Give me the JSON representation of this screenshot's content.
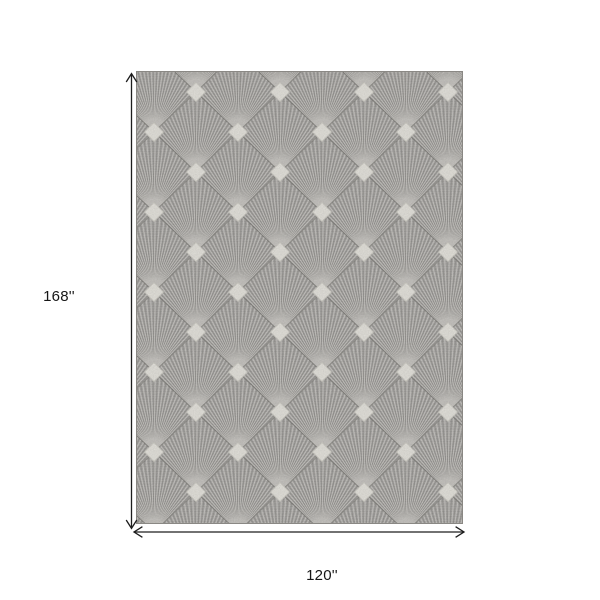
{
  "dimensions": {
    "height": "168''",
    "width": "120''"
  },
  "colors": {
    "background": "#ffffff",
    "rug_field": "#aaa8a5",
    "rug_motif": "#eae8e1",
    "dimension_line": "#1d1d1d"
  }
}
